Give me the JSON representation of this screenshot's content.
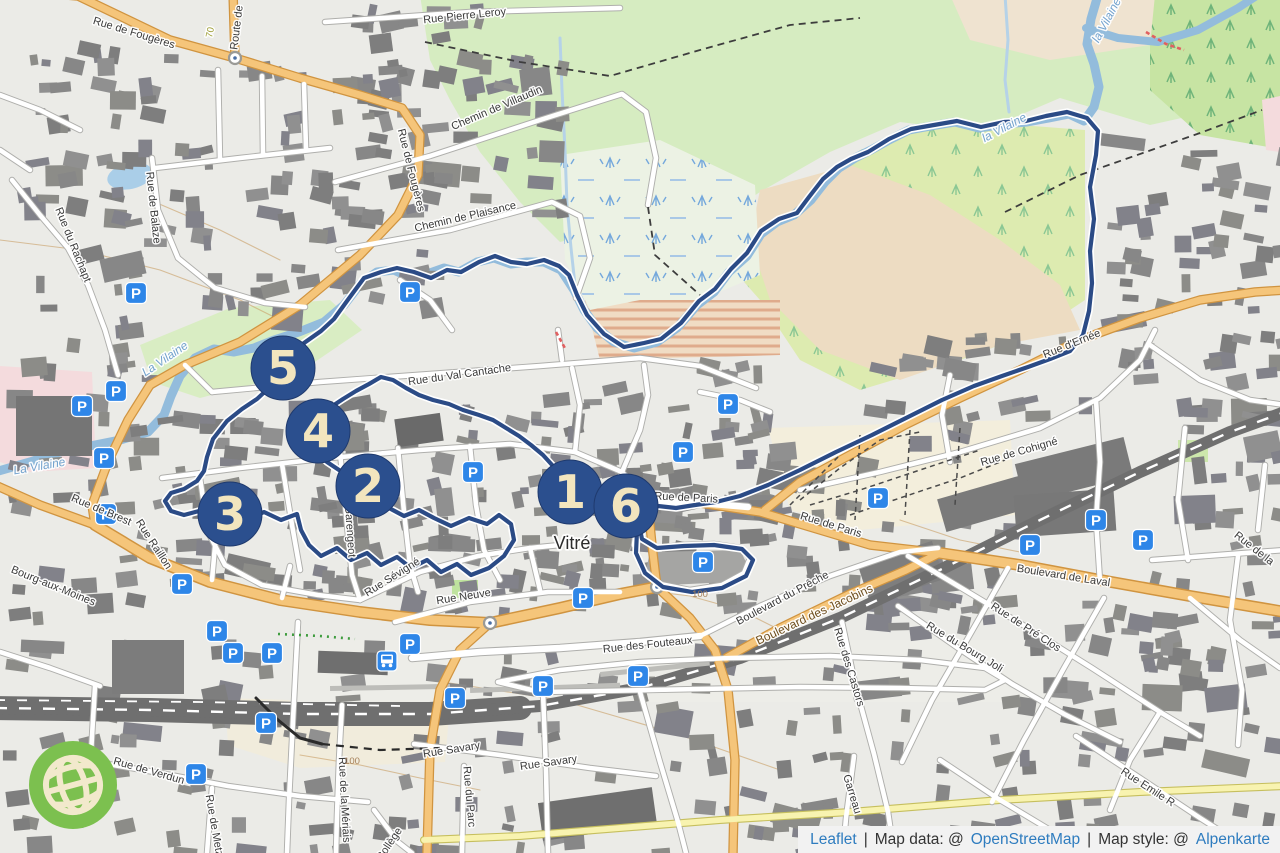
{
  "city": {
    "name": "Vitré"
  },
  "attribution": {
    "leaflet": "Leaflet",
    "divider": "|",
    "data_prefix": "Map data: @",
    "data_link": "OpenStreetMap",
    "style_prefix": "Map style: @",
    "style_link": "Alpenkarte"
  },
  "colors": {
    "marker_fill": "#2B4F8E",
    "marker_border": "#1F3A6E",
    "marker_text": "#F2E5BE",
    "parking_blue": "#2E86E8",
    "route": "#2B4B86",
    "river": "#93BCDC",
    "road_orange": "#F5C57A",
    "road_yellow": "#F8F3B0",
    "attribution_link": "#2E7CBF",
    "water_label": "#74A3CE"
  },
  "markers": [
    {
      "label": "5",
      "x": 283,
      "y": 368
    },
    {
      "label": "4",
      "x": 318,
      "y": 431
    },
    {
      "label": "2",
      "x": 368,
      "y": 486
    },
    {
      "label": "3",
      "x": 230,
      "y": 514
    },
    {
      "label": "1",
      "x": 570,
      "y": 492
    },
    {
      "label": "6",
      "x": 626,
      "y": 506
    }
  ],
  "parking": [
    [
      136,
      293
    ],
    [
      82,
      406
    ],
    [
      116,
      391
    ],
    [
      104,
      458
    ],
    [
      106,
      514
    ],
    [
      410,
      292
    ],
    [
      473,
      472
    ],
    [
      683,
      452
    ],
    [
      728,
      404
    ],
    [
      703,
      562
    ],
    [
      878,
      498
    ],
    [
      1030,
      545
    ],
    [
      1096,
      520
    ],
    [
      1143,
      540
    ],
    [
      583,
      598
    ],
    [
      182,
      584
    ],
    [
      217,
      631
    ],
    [
      233,
      653
    ],
    [
      272,
      653
    ],
    [
      410,
      644
    ],
    [
      543,
      686
    ],
    [
      638,
      676
    ],
    [
      266,
      723
    ],
    [
      196,
      774
    ],
    [
      455,
      698
    ]
  ],
  "bus_stop": {
    "x": 387,
    "y": 661
  },
  "roundabouts": [
    [
      235,
      58
    ],
    [
      490,
      623
    ],
    [
      657,
      587
    ]
  ],
  "street_labels": [
    {
      "t": "Rue Pierre Leroy",
      "x": 465,
      "y": 19,
      "r": -6
    },
    {
      "t": "Rue de Fougères",
      "x": 133,
      "y": 36,
      "r": 17
    },
    {
      "t": "Route de",
      "x": 240,
      "y": 28,
      "r": -83
    },
    {
      "t": "70",
      "x": 213,
      "y": 33,
      "r": -78,
      "k": "ref"
    },
    {
      "t": "Chemin de Villaudin",
      "x": 498,
      "y": 111,
      "r": -23
    },
    {
      "t": "Chemin de Plaisance",
      "x": 466,
      "y": 220,
      "r": -13
    },
    {
      "t": "Rue de Balaze",
      "x": 150,
      "y": 208,
      "r": 84
    },
    {
      "t": "Rue du Rachapt",
      "x": 70,
      "y": 246,
      "r": 68
    },
    {
      "t": "Rue de Fougères",
      "x": 408,
      "y": 171,
      "r": 76
    },
    {
      "t": "Rue du Val Cantache",
      "x": 460,
      "y": 378,
      "r": -8
    },
    {
      "t": "la Vilaine",
      "x": 1006,
      "y": 131,
      "r": -28,
      "k": "water"
    },
    {
      "t": "la Vilaine",
      "x": 1110,
      "y": 22,
      "r": -62,
      "k": "water"
    },
    {
      "t": "La Vilaine",
      "x": 40,
      "y": 470,
      "r": -10,
      "k": "water"
    },
    {
      "t": "La Vilaine",
      "x": 167,
      "y": 362,
      "r": -34,
      "k": "water"
    },
    {
      "t": "Rue d'Ernée",
      "x": 1073,
      "y": 347,
      "r": -22
    },
    {
      "t": "Rue de Cohigné",
      "x": 1020,
      "y": 455,
      "r": -16
    },
    {
      "t": "Rue de Paris",
      "x": 686,
      "y": 501,
      "r": 3
    },
    {
      "t": "Rue de Paris",
      "x": 830,
      "y": 528,
      "r": 17
    },
    {
      "t": "Boulevard de Laval",
      "x": 1063,
      "y": 579,
      "r": 9
    },
    {
      "t": "Rue de Brest",
      "x": 100,
      "y": 513,
      "r": 23
    },
    {
      "t": "Rue Raillon",
      "x": 151,
      "y": 546,
      "r": 57
    },
    {
      "t": "Bourg-aux-Moines",
      "x": 52,
      "y": 589,
      "r": 22
    },
    {
      "t": "Rue Garengeot",
      "x": 346,
      "y": 520,
      "r": 86
    },
    {
      "t": "Rue Sévigné",
      "x": 394,
      "y": 580,
      "r": -32
    },
    {
      "t": "Rue Neuve",
      "x": 464,
      "y": 600,
      "r": -9
    },
    {
      "t": "Rue des Fouteaux",
      "x": 648,
      "y": 648,
      "r": -6
    },
    {
      "t": "Boulevard du Prêche",
      "x": 784,
      "y": 601,
      "r": -28
    },
    {
      "t": "Boulevard des Jacobins",
      "x": 816,
      "y": 618,
      "r": -25,
      "k": "major"
    },
    {
      "t": "Rue des Castors",
      "x": 846,
      "y": 668,
      "r": 73
    },
    {
      "t": "Rue du Bourg Joli",
      "x": 963,
      "y": 650,
      "r": 31
    },
    {
      "t": "Rue de Pré Clos",
      "x": 1024,
      "y": 630,
      "r": 33
    },
    {
      "t": "Rue Emile R",
      "x": 1146,
      "y": 790,
      "r": 33
    },
    {
      "t": "Garreau",
      "x": 849,
      "y": 795,
      "r": 73
    },
    {
      "t": "Rue Savary",
      "x": 452,
      "y": 753,
      "r": -9
    },
    {
      "t": "Rue Savary",
      "x": 549,
      "y": 766,
      "r": -8
    },
    {
      "t": "Rue du Parc",
      "x": 466,
      "y": 797,
      "r": 85
    },
    {
      "t": "Rue de la Mériais",
      "x": 341,
      "y": 800,
      "r": 87
    },
    {
      "t": "Rue de Metz",
      "x": 211,
      "y": 826,
      "r": 80
    },
    {
      "t": "Rue de Verdun",
      "x": 148,
      "y": 774,
      "r": 16
    },
    {
      "t": "Collège",
      "x": 392,
      "y": 846,
      "r": -56
    },
    {
      "t": "Rue de la",
      "x": 1252,
      "y": 551,
      "r": 38
    },
    {
      "t": "Vitré",
      "x": 572,
      "y": 549,
      "r": 0,
      "k": "city"
    },
    {
      "t": "100",
      "x": 700,
      "y": 597,
      "r": 0,
      "k": "contour"
    },
    {
      "t": "100",
      "x": 352,
      "y": 764,
      "r": 0,
      "k": "contour"
    }
  ],
  "route": {
    "color": "#2B4B86",
    "points": [
      [
        626,
        506
      ],
      [
        639,
        513
      ],
      [
        637,
        531
      ],
      [
        636,
        553
      ],
      [
        645,
        573
      ],
      [
        663,
        587
      ],
      [
        692,
        592
      ],
      [
        722,
        588
      ],
      [
        746,
        576
      ],
      [
        753,
        560
      ],
      [
        742,
        549
      ],
      [
        714,
        545
      ],
      [
        684,
        546
      ],
      [
        657,
        548
      ],
      [
        642,
        539
      ],
      [
        638,
        520
      ],
      [
        641,
        509
      ],
      [
        658,
        506
      ],
      [
        676,
        508
      ],
      [
        695,
        505
      ],
      [
        716,
        502
      ],
      [
        740,
        496
      ],
      [
        768,
        485
      ],
      [
        800,
        470
      ],
      [
        836,
        452
      ],
      [
        872,
        435
      ],
      [
        908,
        417
      ],
      [
        942,
        400
      ],
      [
        974,
        386
      ],
      [
        1002,
        376
      ],
      [
        1028,
        367
      ],
      [
        1050,
        359
      ],
      [
        1070,
        351
      ],
      [
        1083,
        335
      ],
      [
        1089,
        311
      ],
      [
        1092,
        283
      ],
      [
        1090,
        251
      ],
      [
        1094,
        219
      ],
      [
        1090,
        187
      ],
      [
        1096,
        155
      ],
      [
        1098,
        131
      ],
      [
        1087,
        118
      ],
      [
        1067,
        112
      ],
      [
        1046,
        116
      ],
      [
        1026,
        121
      ],
      [
        1004,
        122
      ],
      [
        981,
        127
      ],
      [
        957,
        121
      ],
      [
        934,
        125
      ],
      [
        911,
        129
      ],
      [
        889,
        139
      ],
      [
        868,
        152
      ],
      [
        851,
        159
      ],
      [
        837,
        167
      ],
      [
        823,
        179
      ],
      [
        809,
        197
      ],
      [
        797,
        213
      ],
      [
        779,
        219
      ],
      [
        761,
        231
      ],
      [
        747,
        253
      ],
      [
        731,
        269
      ],
      [
        715,
        289
      ],
      [
        699,
        301
      ],
      [
        681,
        323
      ],
      [
        661,
        339
      ],
      [
        644,
        343
      ],
      [
        624,
        347
      ],
      [
        604,
        334
      ],
      [
        587,
        315
      ],
      [
        577,
        295
      ],
      [
        569,
        275
      ],
      [
        559,
        266
      ],
      [
        544,
        260
      ],
      [
        527,
        264
      ],
      [
        511,
        262
      ],
      [
        495,
        256
      ],
      [
        479,
        262
      ],
      [
        461,
        272
      ],
      [
        447,
        270
      ],
      [
        431,
        278
      ],
      [
        414,
        272
      ],
      [
        397,
        268
      ],
      [
        381,
        272
      ],
      [
        364,
        278
      ],
      [
        347,
        301
      ],
      [
        334,
        319
      ],
      [
        321,
        331
      ],
      [
        304,
        343
      ],
      [
        289,
        353
      ],
      [
        283,
        368
      ],
      [
        271,
        386
      ],
      [
        257,
        399
      ],
      [
        242,
        409
      ],
      [
        227,
        421
      ],
      [
        213,
        439
      ],
      [
        207,
        457
      ],
      [
        204,
        471
      ],
      [
        197,
        481
      ],
      [
        184,
        489
      ],
      [
        171,
        493
      ],
      [
        165,
        501
      ],
      [
        171,
        511
      ],
      [
        184,
        515
      ],
      [
        199,
        511
      ],
      [
        214,
        506
      ],
      [
        230,
        514
      ],
      [
        247,
        520
      ],
      [
        264,
        512
      ],
      [
        281,
        520
      ],
      [
        297,
        514
      ],
      [
        301,
        530
      ],
      [
        309,
        545
      ],
      [
        321,
        556
      ],
      [
        337,
        548
      ],
      [
        351,
        560
      ],
      [
        367,
        553
      ],
      [
        381,
        565
      ],
      [
        397,
        557
      ],
      [
        411,
        568
      ],
      [
        427,
        560
      ],
      [
        441,
        572
      ],
      [
        457,
        564
      ],
      [
        471,
        575
      ],
      [
        489,
        568
      ],
      [
        504,
        556
      ],
      [
        514,
        540
      ],
      [
        511,
        524
      ],
      [
        499,
        515
      ],
      [
        487,
        524
      ],
      [
        469,
        518
      ],
      [
        451,
        526
      ],
      [
        434,
        518
      ],
      [
        419,
        510
      ],
      [
        404,
        516
      ],
      [
        389,
        508
      ],
      [
        374,
        500
      ],
      [
        368,
        486
      ],
      [
        354,
        478
      ],
      [
        339,
        470
      ],
      [
        327,
        462
      ],
      [
        317,
        452
      ],
      [
        314,
        440
      ],
      [
        318,
        431
      ],
      [
        322,
        417
      ],
      [
        331,
        407
      ],
      [
        343,
        399
      ],
      [
        356,
        391
      ],
      [
        369,
        384
      ],
      [
        381,
        377
      ],
      [
        393,
        380
      ],
      [
        406,
        388
      ],
      [
        419,
        395
      ],
      [
        433,
        400
      ],
      [
        449,
        404
      ],
      [
        463,
        410
      ],
      [
        479,
        415
      ],
      [
        493,
        420
      ],
      [
        506,
        428
      ],
      [
        519,
        436
      ],
      [
        531,
        445
      ],
      [
        543,
        455
      ],
      [
        553,
        466
      ],
      [
        561,
        478
      ],
      [
        570,
        492
      ]
    ]
  }
}
